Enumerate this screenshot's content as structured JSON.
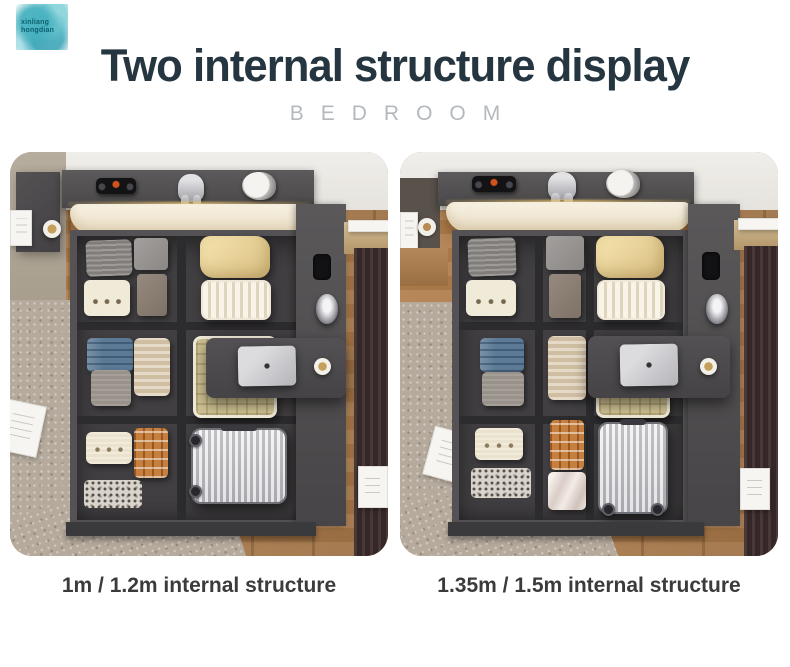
{
  "brand": {
    "watermark_line1": "xinliang",
    "watermark_line2": "hongdian"
  },
  "header": {
    "title": "Two internal structure display",
    "subtitle": "BEDROOM"
  },
  "panels": [
    {
      "caption": "1m / 1.2m internal structure"
    },
    {
      "caption": "1.35m / 1.5m internal structure"
    }
  ],
  "colors": {
    "title": "#263641",
    "subtitle": "#b4b9bd",
    "caption": "#3c3b3b",
    "watermark_teal": "#35a7b6",
    "cabinet_gray": "#4b494b",
    "cushion_cream": "#f3ecda",
    "wood_floor": "#b1804f",
    "curtain_brown": "#3e2d2d",
    "pillow_yellow": "#e3cf96"
  }
}
